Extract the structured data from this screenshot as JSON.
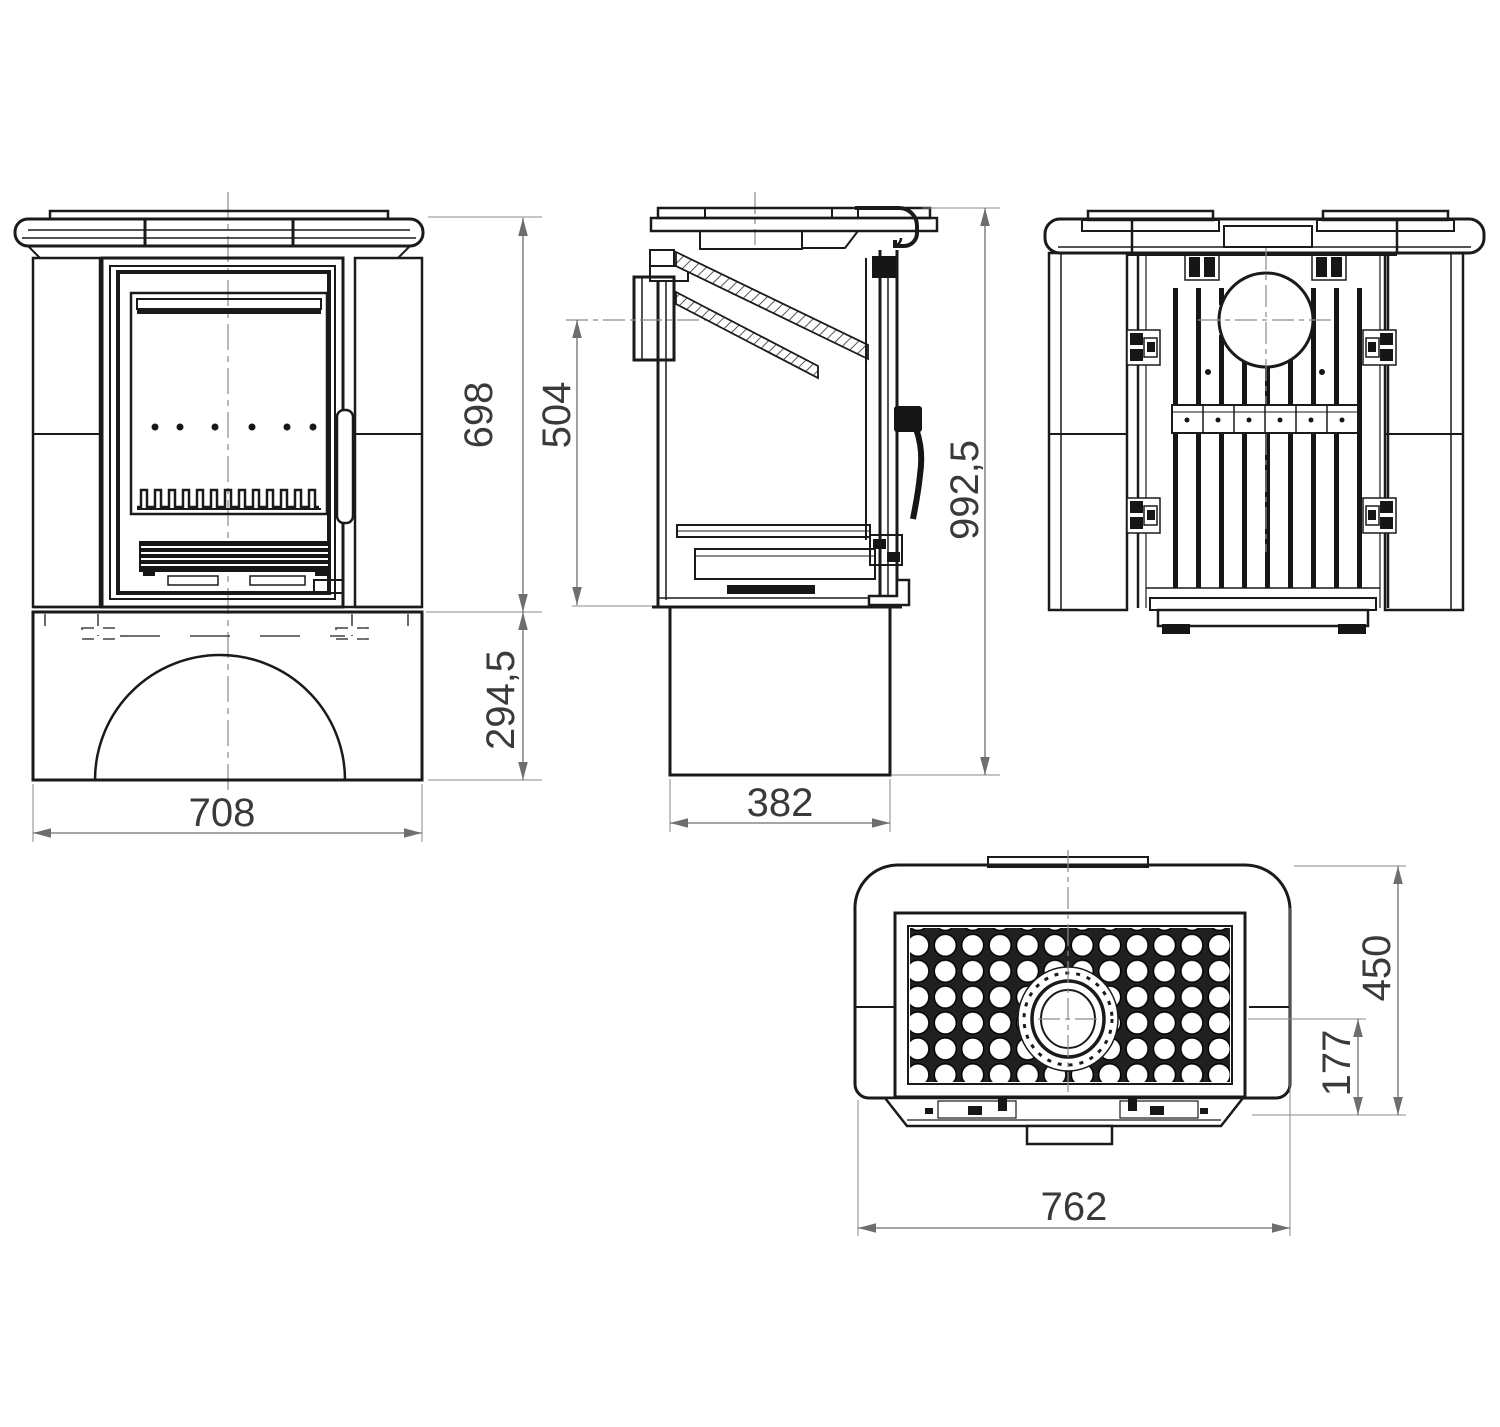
{
  "drawing": {
    "kind": "stove-dimensional-drawing",
    "background": "#ffffff"
  },
  "colors": {
    "line": "#1a1a1a",
    "dark_fill": "#161616",
    "dimension_line": "#6e6e6e",
    "dimension_text": "#3a3a3a",
    "centerline": "#8a8a8a"
  },
  "dimensions": {
    "front_upper_height": "698",
    "front_base_height": "294,5",
    "front_width": "708",
    "side_flue_center_height": "504",
    "side_pedestal_depth": "382",
    "overall_height": "992,5",
    "top_depth": "450",
    "flue_center_to_rear": "177",
    "top_width": "762"
  }
}
